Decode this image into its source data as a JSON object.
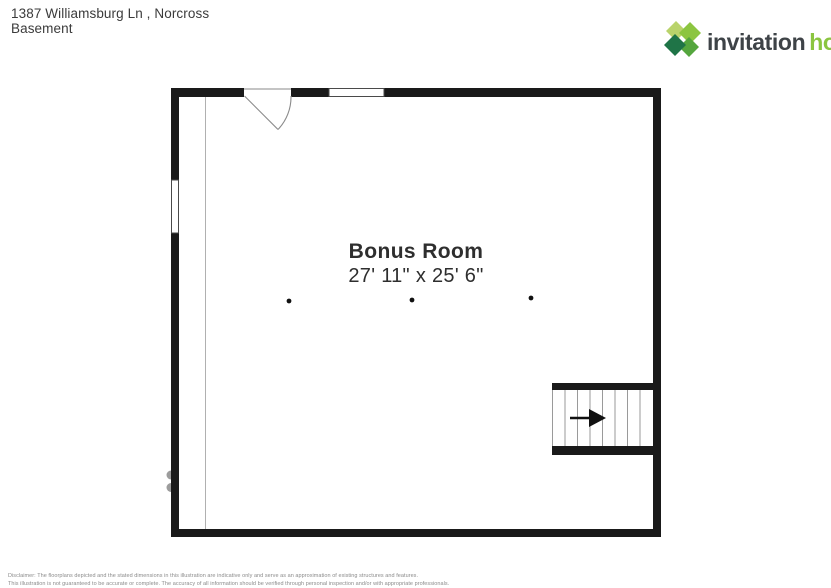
{
  "header": {
    "address_line1": "1387 Williamsburg Ln , Norcross",
    "address_line2": "Basement"
  },
  "logo": {
    "word1": "invitation",
    "word2": "homes",
    "trademark": "®",
    "icon": "invitation-homes-diamond-logo",
    "colors": {
      "word1_color": "#3e4347",
      "word2_color": "#8bc540",
      "icon_light_green": "#b9d36b",
      "icon_mid_green": "#8cc540",
      "icon_mid_dark_green": "#55a63e",
      "icon_dark_green": "#1f7447"
    }
  },
  "floorplan": {
    "room": {
      "name": "Bonus Room",
      "dimensions": "27' 11\" x 25' 6\""
    },
    "symbols": {
      "stairs_direction_icon": "right-arrow-icon",
      "door_swing_icon": "door-swing-arc",
      "ceiling_dots": 3
    },
    "colors": {
      "wall": "#1a1a1a",
      "thin_line": "#a8a8a8"
    }
  },
  "disclaimer": {
    "line1": "Disclaimer: The floorplans depicted and the stated dimensions in this illustration are indicative only and serve as an approximation of existing structures and features.",
    "line2": "This illustration is not guaranteed to be accurate or complete. The accuracy of all information should be verified through personal inspection and/or with appropriate professionals."
  }
}
